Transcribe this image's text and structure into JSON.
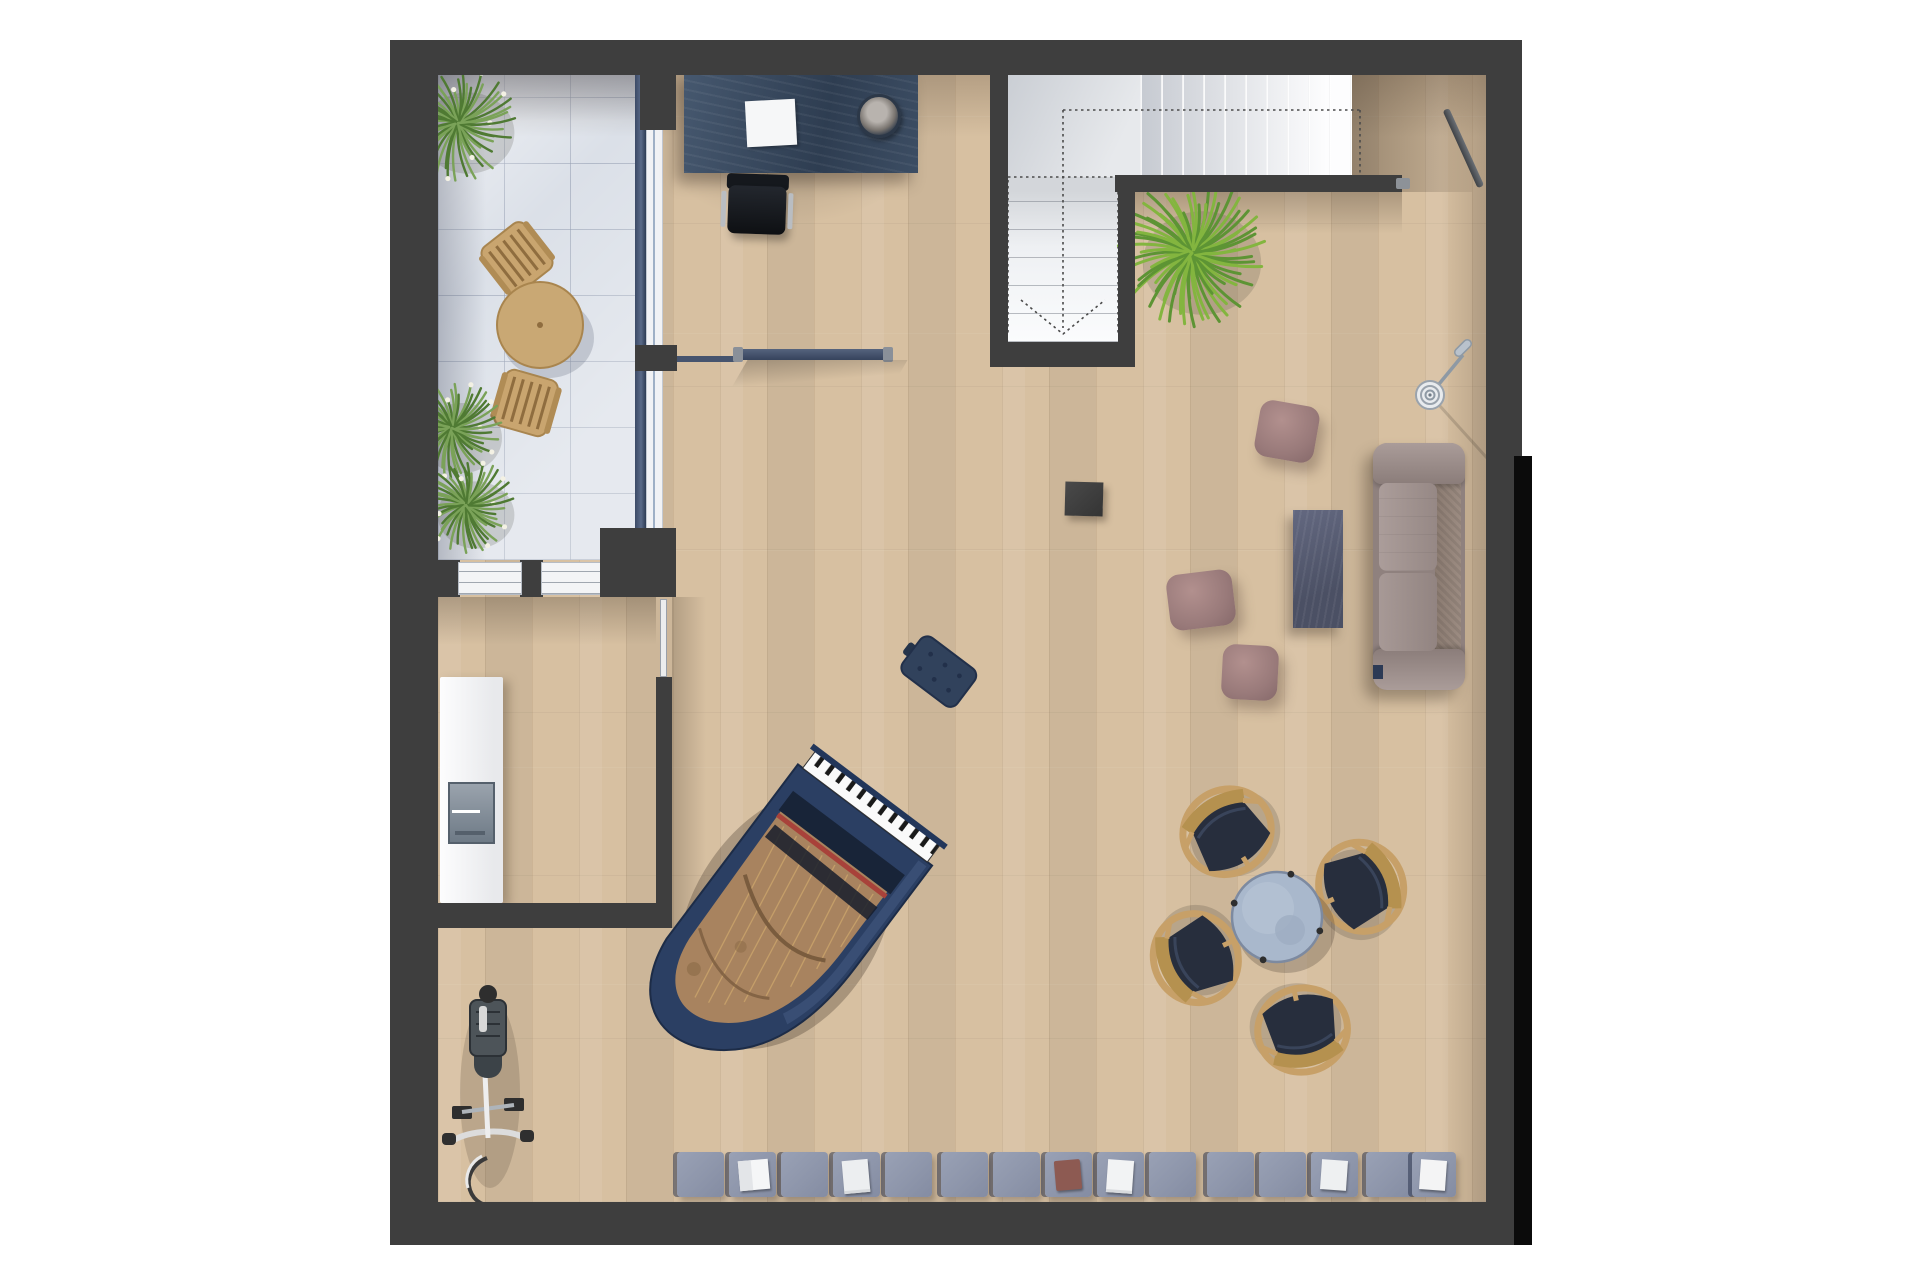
{
  "scene": {
    "kind": "top-down 3D rendered apartment floor plan",
    "canvas": {
      "width": 1920,
      "height": 1280
    },
    "visible_text": "none"
  },
  "palette": {
    "wall": "#3e3e3e",
    "wall_shadow": "#0b0b0b",
    "wood": "#d7c0a1",
    "tile": "#dbe0e8",
    "stair_white": "#f7f8fa",
    "navy": "#2b3f63",
    "desk": "#39495f",
    "sofa": "#8f817e",
    "sofa_seat": "#a29492",
    "pouf": "#997a7a",
    "coffee_table": "#575c6f",
    "cushion": "#8e96ab",
    "table_top": "#aab9ce",
    "chair_wood": "#c7a068",
    "chair_seat": "#272e3d",
    "grass_green": "#6c9450",
    "yucca_green": "#83b53f",
    "bench": "#31425c",
    "cabinet": "#f4f5f7"
  },
  "rooms": [
    {
      "id": "terrace",
      "floor": "tile",
      "contents": [
        "grass-plants",
        "round-wood-table",
        "2 wood chairs"
      ]
    },
    {
      "id": "office-nook",
      "floor": "wood",
      "contents": [
        "navy-desk",
        "paper-sheet",
        "round-tray",
        "office-chair"
      ]
    },
    {
      "id": "stairwell",
      "floor": "white",
      "contents": [
        "L-shaped stair"
      ]
    },
    {
      "id": "entry-hall",
      "floor": "wood",
      "contents": [
        "entry-door"
      ]
    },
    {
      "id": "living-music-room",
      "floor": "wood",
      "contents": [
        "grand-piano",
        "piano-bench",
        "sofa",
        "3 poufs",
        "coffee-table",
        "side-cube",
        "floor-lamp",
        "dining-set",
        "cushion-row",
        "yucca-plant"
      ]
    },
    {
      "id": "utility-room",
      "floor": "wood",
      "contents": [
        "white-cabinet",
        "door"
      ]
    },
    {
      "id": "bike-corner",
      "floor": "wood",
      "contents": [
        "bicycle"
      ]
    }
  ],
  "stairs": {
    "upper_steps": 10,
    "lower_steps": 6,
    "direction_line": "dashed with V arrow"
  },
  "cushion_row": {
    "y": 1152,
    "height": 45,
    "default_width": 47,
    "cushions": [
      {
        "x": 677
      },
      {
        "x": 729
      },
      {
        "x": 781
      },
      {
        "x": 833
      },
      {
        "x": 885
      },
      {
        "x": 941
      },
      {
        "x": 993
      },
      {
        "x": 1045
      },
      {
        "x": 1097
      },
      {
        "x": 1149
      },
      {
        "x": 1207
      },
      {
        "x": 1259
      },
      {
        "x": 1311
      },
      {
        "x": 1366
      },
      {
        "x": 1412,
        "w": 44
      }
    ],
    "books": [
      {
        "cushion": 1,
        "type": "open-book",
        "color": "#f5f6f7"
      },
      {
        "cushion": 3,
        "type": "paper",
        "color": "#eceef0"
      },
      {
        "cushion": 7,
        "type": "red-book",
        "color": "#8d5a52"
      },
      {
        "cushion": 8,
        "type": "paper-stack",
        "color": "#f2f3f4"
      },
      {
        "cushion": 12,
        "type": "magazine",
        "color": "#eef0f1"
      },
      {
        "cushion": 14,
        "type": "book",
        "color": "#f4f4f5"
      }
    ]
  },
  "plants": [
    {
      "cx": 458,
      "cy": 123,
      "r": 58,
      "style": "grass"
    },
    {
      "cx": 452,
      "cy": 428,
      "r": 50,
      "style": "grass"
    },
    {
      "cx": 466,
      "cy": 505,
      "r": 48,
      "style": "grass"
    },
    {
      "cx": 1192,
      "cy": 253,
      "r": 74,
      "style": "yucca"
    }
  ],
  "dining_set": {
    "table": {
      "cx": 1277,
      "cy": 917,
      "r": 45
    },
    "chairs": [
      {
        "cx": 1226,
        "cy": 830,
        "rot": -32
      },
      {
        "cx": 1363,
        "cy": 886,
        "rot": 66
      },
      {
        "cx": 1194,
        "cy": 959,
        "rot": -115
      },
      {
        "cx": 1303,
        "cy": 1032,
        "rot": 168
      }
    ]
  },
  "terrace_set": {
    "table": {
      "cx": 540,
      "cy": 325,
      "r": 43
    },
    "chairs": [
      {
        "cx": 517,
        "cy": 258,
        "rot": -38
      },
      {
        "cx": 526,
        "cy": 403,
        "rot": 196
      }
    ]
  },
  "piano": {
    "cx": 865,
    "cy": 815,
    "rotation_deg": 37,
    "color": "navy",
    "lid": "open"
  },
  "counts": {
    "poufs": 3,
    "cushions": 15,
    "dining_chairs": 4,
    "terrace_chairs": 2
  }
}
